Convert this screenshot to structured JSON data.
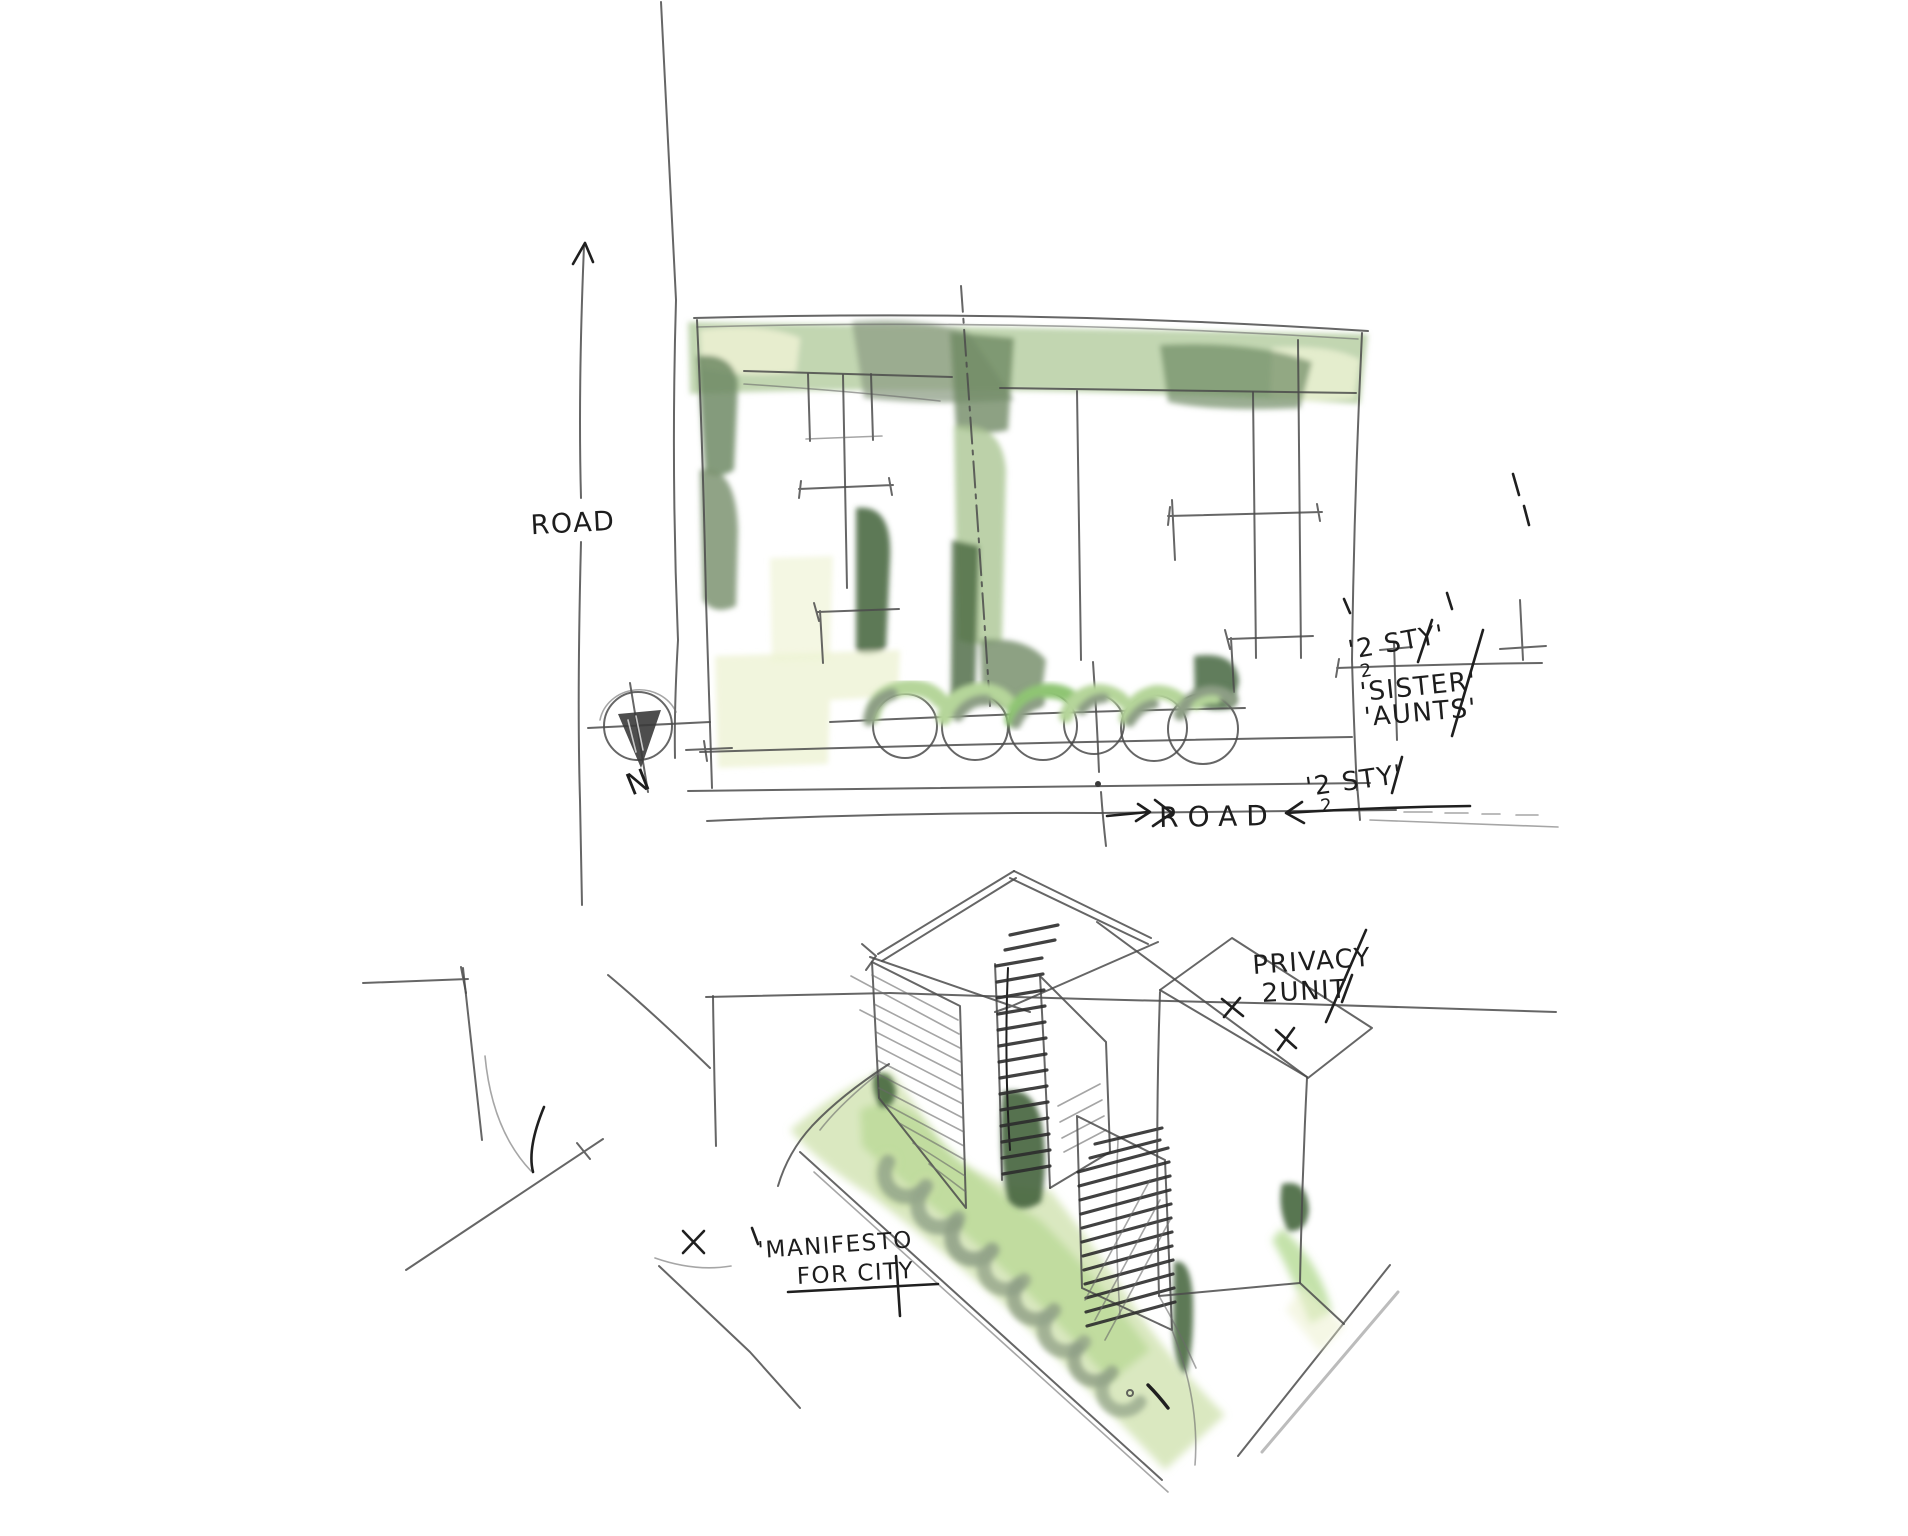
{
  "palette": {
    "paper": "#ffffff",
    "pencil": "#4b4b4b",
    "ink": "#1f1f1f",
    "wash_main": "#abc693",
    "wash_light": "#cfe2ae",
    "wash_pale": "#eef2d4",
    "wash_dark": "#6f8a64",
    "wash_deep": "#47663f",
    "wash_grey": "#8d9e85"
  },
  "plan": {
    "road_label_vertical": "ROAD",
    "road_label_horizontal": "ROAD",
    "compass_north": "N",
    "storey_note_upper": "'2 STY'",
    "storey_sub_upper": "2",
    "neighbor_note_1": "'SISTER'",
    "neighbor_note_2": "'AUNTS'",
    "storey_note_lower": "'2 STY'",
    "storey_sub_lower": "2"
  },
  "perspective": {
    "privacy_note_line1": "PRIVACY",
    "privacy_note_line2": "2UNIT",
    "manifesto_note_line1": "'MANIFESTO",
    "manifesto_note_line2": "FOR CITY"
  }
}
